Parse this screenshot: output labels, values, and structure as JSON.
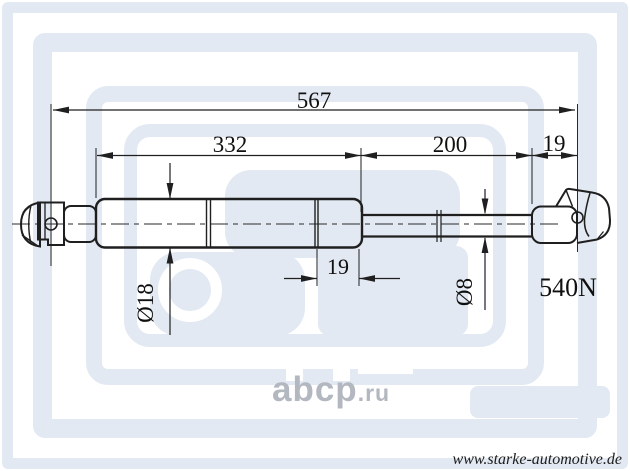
{
  "watermarks": {
    "abcp_brand": "abcp",
    "abcp_tld": ".ru",
    "site_url": "www.starke-automotive.de"
  },
  "drawing": {
    "part_type": "gas-spring-technical-drawing",
    "force_rating": "540N",
    "dimensions": {
      "overall_length": "567",
      "cylinder_length": "332",
      "rod_length": "200",
      "end_fitting_width": "19",
      "cylinder_end_cap": "19",
      "cylinder_diameter": "Ø18",
      "rod_diameter": "Ø8"
    }
  },
  "colors": {
    "line": "#1f1f1f",
    "watermark_light": "#e3e9f2",
    "abcp_gray": "#b3b7bf"
  }
}
